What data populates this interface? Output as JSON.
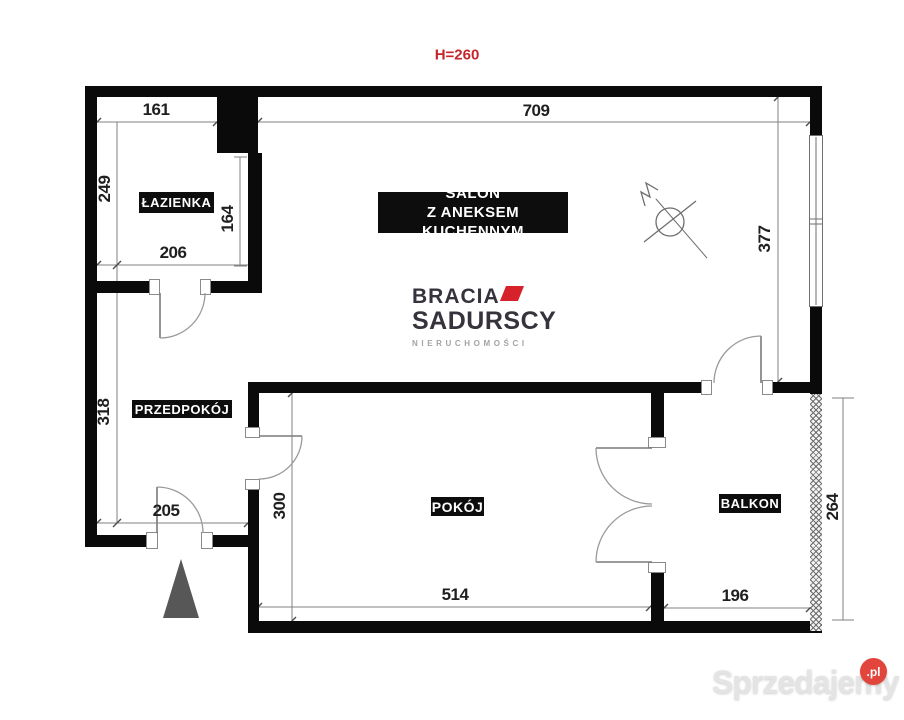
{
  "plan": {
    "height_note": "H=260",
    "rooms": {
      "lazienka": "ŁAZIENKA",
      "salon_line1": "SALON",
      "salon_line2": "Z ANEKSEM KUCHENNYM",
      "przedpokoj": "PRZEDPOKÓJ",
      "pokoj": "POKÓJ",
      "balkon": "BALKON"
    },
    "dims": {
      "lazienka_width_top": "161",
      "salon_width_top": "709",
      "lazienka_height_left": "249",
      "lazienka_height_right": "164",
      "lazienka_width_bottom": "206",
      "przedpokoj_height": "318",
      "przedpokoj_width": "205",
      "salon_height_right": "377",
      "pokoj_height": "300",
      "pokoj_width": "514",
      "balkon_width": "196",
      "balkon_height": "264"
    }
  },
  "branding": {
    "logo_line1": "BRACIA",
    "logo_line2": "SADURSCY",
    "logo_line3": "NIERUCHOMOŚCI",
    "logo_accent_color": "#d6232b"
  },
  "watermark": {
    "text": "Sprzedajemy",
    "badge": ".pl",
    "badge_color": "#e2453c"
  },
  "colors": {
    "wall": "#0a0a0a",
    "dimension_text": "#1f1f1f",
    "height_note_color": "#c4262c"
  }
}
